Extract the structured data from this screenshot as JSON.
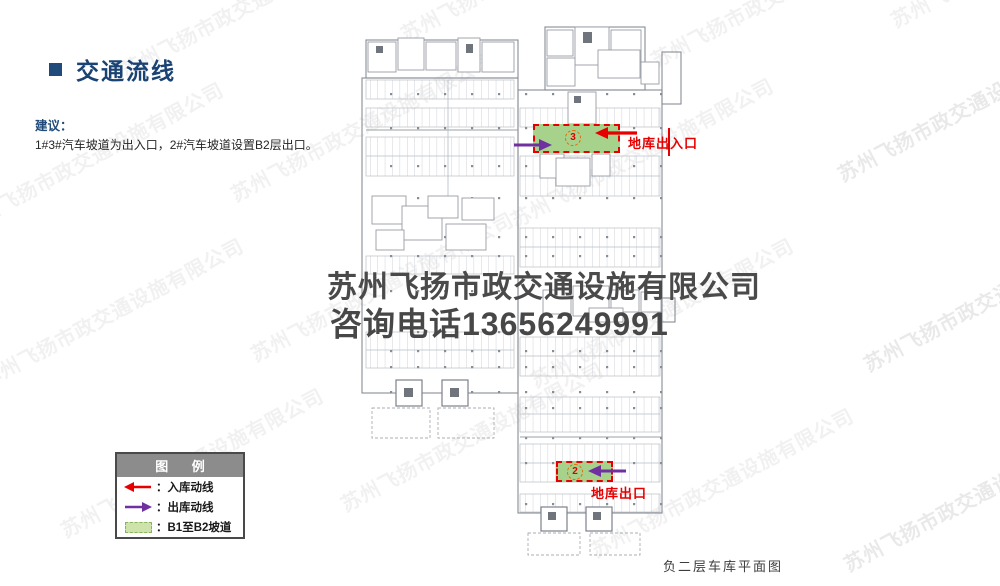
{
  "header": {
    "title": "交通流线",
    "bullet_icon": "blue-square"
  },
  "suggestion": {
    "label": "建议：",
    "text": "1#3#汽车坡道为出入口，2#汽车坡道设置B2层出口。"
  },
  "watermark": {
    "diagonal_text": "苏州飞扬市政交通设施有限公司",
    "center_line1": "苏州飞扬市政交通设施有限公司",
    "center_line2": "咨询电话13656249991"
  },
  "plan": {
    "caption": "负二层车库平面图",
    "annotations": {
      "entrance_exit": {
        "label": "地库出入口",
        "ramp_number": "3"
      },
      "exit": {
        "label": "地库出口",
        "ramp_number": "2"
      }
    }
  },
  "legend": {
    "title": "图 例",
    "items": [
      {
        "symbol": "red-left-arrow",
        "label": "：入库动线"
      },
      {
        "symbol": "purple-right-arrow",
        "label": "：出库动线"
      },
      {
        "symbol": "green-dashed-box",
        "label": "：B1至B2坡道"
      }
    ]
  },
  "colors": {
    "title_navy": "#1A4373",
    "inbound_red": "#E60000",
    "outbound_purple": "#7030A0",
    "ramp_green_fill": "#A6D28C",
    "legend_swatch_green": "#CDE3AB",
    "legend_header_gray": "#8C8C8C"
  }
}
